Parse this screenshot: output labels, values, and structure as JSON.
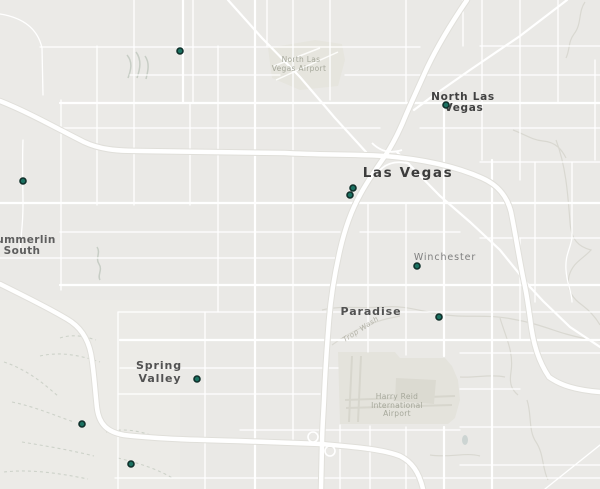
{
  "map_region": "Las Vegas, Nevada",
  "colors": {
    "background": "#eae9e6",
    "road": "#ffffff",
    "freeway_casing": "#e0dfda",
    "airport_fill": "#e5e4dd",
    "runway": "#d7d6cd",
    "wash": "#d9d8d1",
    "trail": "#cdd2c9",
    "pond": "#ccd4d2",
    "marker_fill": "#1b7161",
    "marker_stroke": "#10302b",
    "city_label": "#3c3c3c",
    "district_label": "#525252",
    "muted_label": "#7e7e7e",
    "airport_label": "#a6a89b",
    "wash_label": "#b2b1a6"
  },
  "labels": {
    "las_vegas": "Las Vegas",
    "north_las_vegas": {
      "line1": "North Las",
      "line2": "Vegas"
    },
    "winchester": "Winchester",
    "paradise": "Paradise",
    "spring_valley": {
      "line1": "Spring",
      "line2": "Valley"
    },
    "summerlin_south": {
      "line1": "Summerlin",
      "line2": "South"
    },
    "north_las_vegas_airport": {
      "line1": "North Las",
      "line2": "Vegas Airport"
    },
    "harry_reid_airport": {
      "line1": "Harry Reid",
      "line2": "International",
      "line3": "Airport"
    },
    "trop_wash": "Trop Wash"
  },
  "markers": [
    {
      "x": 180,
      "y": 51
    },
    {
      "x": 446,
      "y": 105
    },
    {
      "x": 23,
      "y": 181
    },
    {
      "x": 353,
      "y": 188
    },
    {
      "x": 350,
      "y": 195
    },
    {
      "x": 417,
      "y": 266
    },
    {
      "x": 439,
      "y": 317
    },
    {
      "x": 197,
      "y": 379
    },
    {
      "x": 82,
      "y": 424
    },
    {
      "x": 131,
      "y": 464
    }
  ]
}
